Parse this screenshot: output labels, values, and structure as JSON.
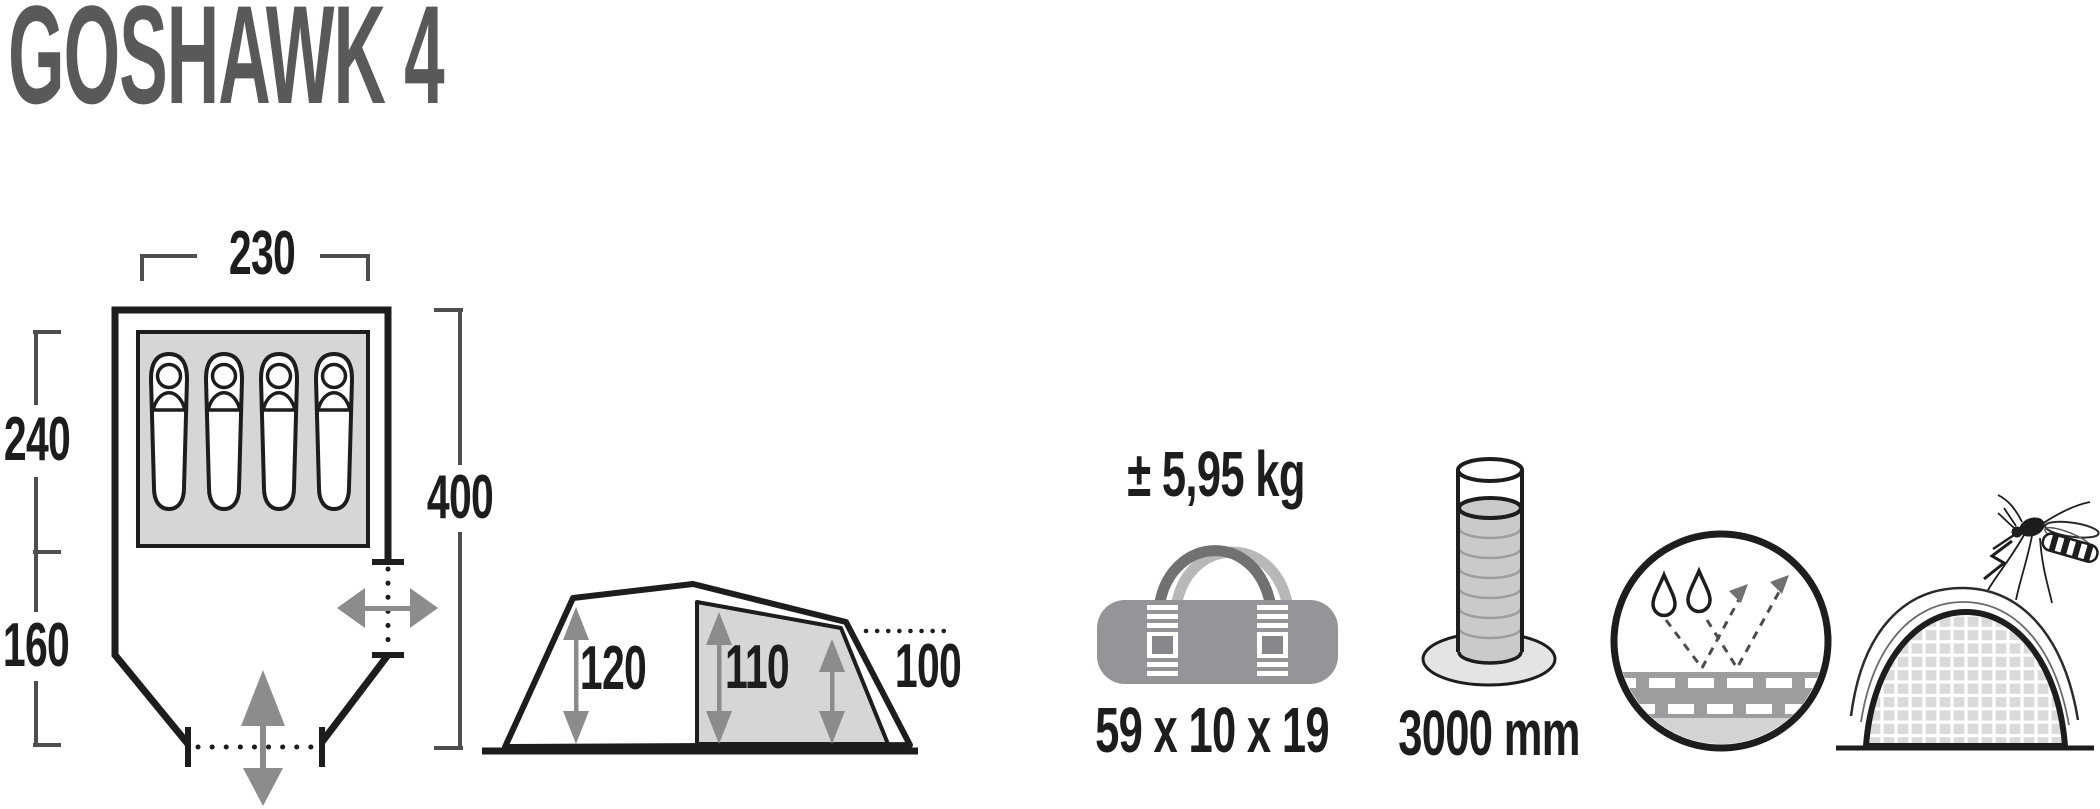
{
  "title": "GOSHAWK 4",
  "floor_plan": {
    "width": "230",
    "sleeping_area_depth": "240",
    "vestibule_depth": "160",
    "total_depth": "400",
    "sleeping_bag_count": 4
  },
  "side_view": {
    "front_height": "120",
    "inner_height": "110",
    "rear_height": "100"
  },
  "pack": {
    "weight": "± 5,95 kg",
    "pack_size": "59 x 10 x 19"
  },
  "water_column": "3000 mm",
  "icons": {
    "pack_bag": "duffel-bag-icon",
    "water_column": "water-column-icon",
    "membrane": "waterproof-membrane-icon",
    "mosquito_net": "mosquito-net-icon",
    "door_front": "double-arrow-vertical-icon",
    "door_side": "double-arrow-horizontal-icon"
  },
  "colors": {
    "title_gray": "#58595b",
    "ink_black": "#1d1d1b",
    "light_gray_fill": "#d5d7d4",
    "mid_gray": "#8b8d8b",
    "bag_gray": "#939598"
  }
}
